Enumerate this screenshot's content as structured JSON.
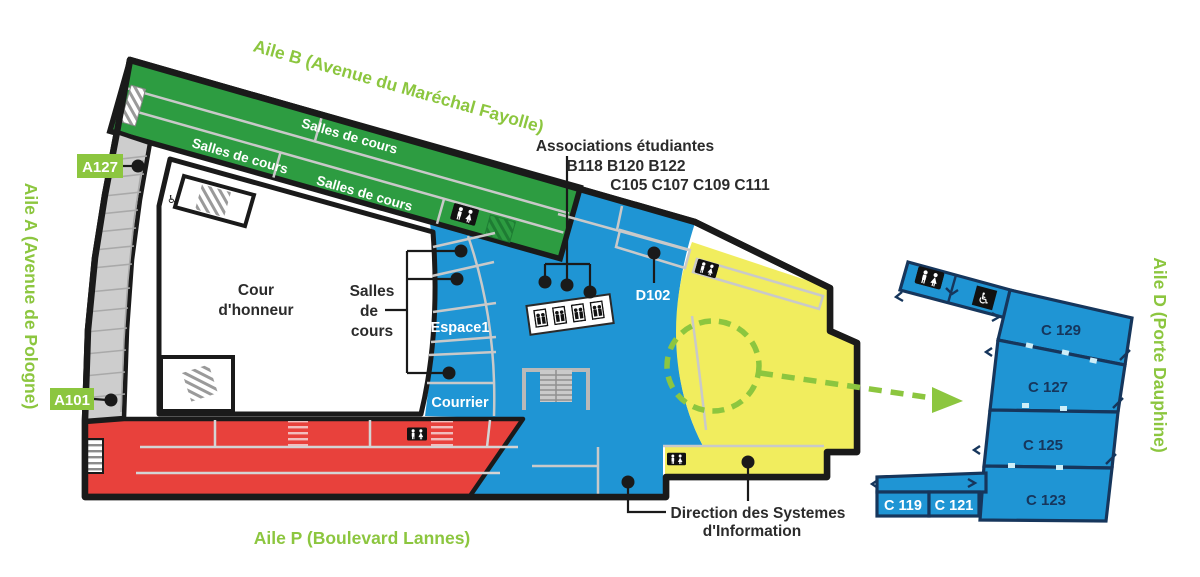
{
  "labels": {
    "aile_b": "Aile B (Avenue du Maréchal Fayolle)",
    "aile_a": "Aile A (Avenue de Pologne)",
    "aile_p": "Aile P (Boulevard Lannes)",
    "aile_d": "Aile D (Porte Dauphine)"
  },
  "badges": {
    "a127": "A127",
    "a101": "A101"
  },
  "green_wing": {
    "salles_1": "Salles de cours",
    "salles_2": "Salles de cours",
    "salles_3": "Salles de cours"
  },
  "courtyard": {
    "line1": "Cour",
    "line2": "d'honneur"
  },
  "center_bracket": {
    "line1": "Salles",
    "line2": "de",
    "line3": "cours"
  },
  "blue_rooms": {
    "espace1": "Espace1",
    "courrier": "Courrier",
    "d102": "D102"
  },
  "associations": {
    "title": "Associations étudiantes",
    "line_b": "B118 B120 B122",
    "line_c": "C105 C107 C109 C111"
  },
  "direction": {
    "line1": "Direction des Systemes",
    "line2": "d'Information"
  },
  "detail_rooms": {
    "c129": "C 129",
    "c127": "C 127",
    "c125": "C 125",
    "c123": "C 123",
    "c119": "C 119",
    "c121": "C 121"
  },
  "icons": {
    "wheelchair_glyph": "♿"
  },
  "colors": {
    "green": "#2D9C41",
    "bright_green": "#8CC63F",
    "blue": "#1F95D4",
    "navy": "#16365C",
    "red": "#E8413C",
    "yellow": "#F1ED5E",
    "gray": "#CDCDCD",
    "outline": "#1A1A1A",
    "white": "#FFFFFF"
  }
}
